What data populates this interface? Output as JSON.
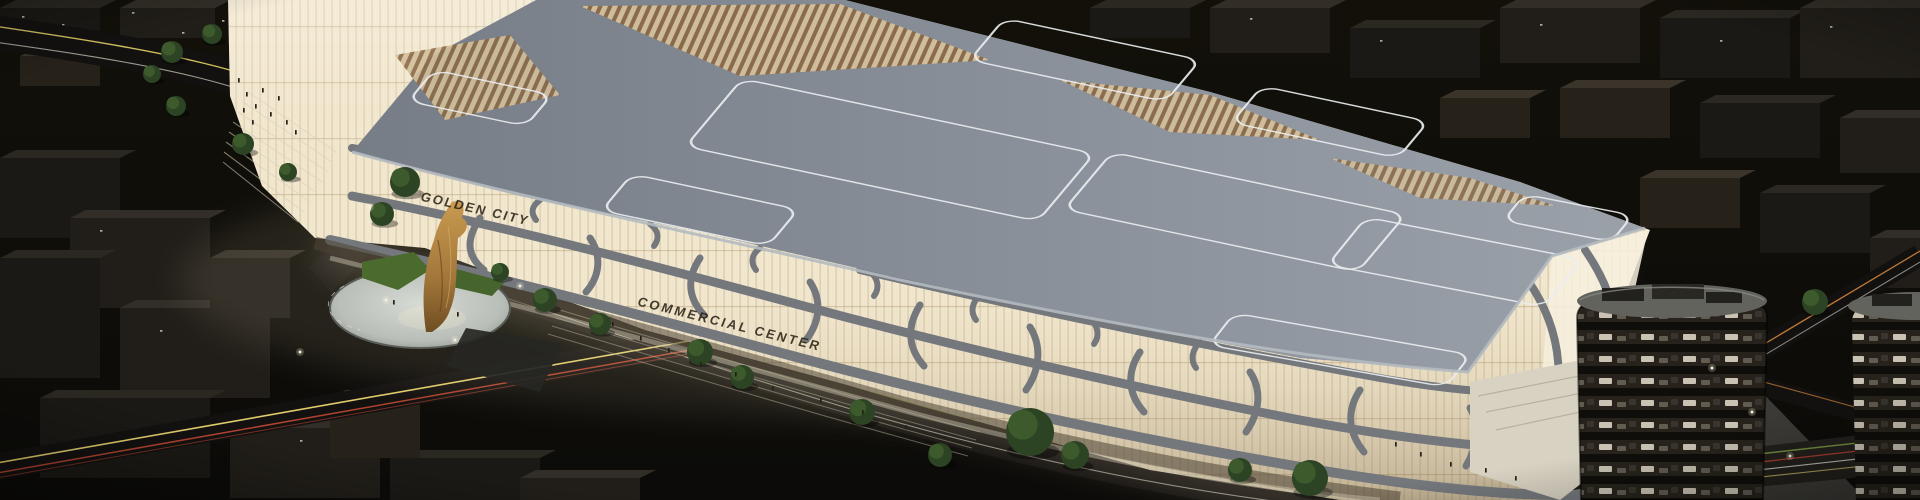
{
  "scene": {
    "type": "night-aerial-architectural-rendering",
    "building_signs": {
      "golden_city": "GOLDEN CITY",
      "commercial_center": "COMMERCIAL CENTER"
    },
    "colors": {
      "night_sky": "#0d0c0a",
      "roof_grey": "#8a919b",
      "roof_line_white": "#e9edef",
      "facade_glow": "#f1e7cf",
      "facade_glow_deep": "#e2cfa8",
      "structure_grey": "#74787c",
      "sculpture_gold": "#b98a42",
      "plaza_light": "#c5cac4",
      "tree_green": "#2c4423",
      "trail_yellow": "#ead670",
      "trail_red": "#c04832",
      "trail_orange": "#d08438",
      "trail_white": "#e0ded2",
      "tower_dark": "#1b1814",
      "window_lit": "#ddd6c6"
    }
  }
}
